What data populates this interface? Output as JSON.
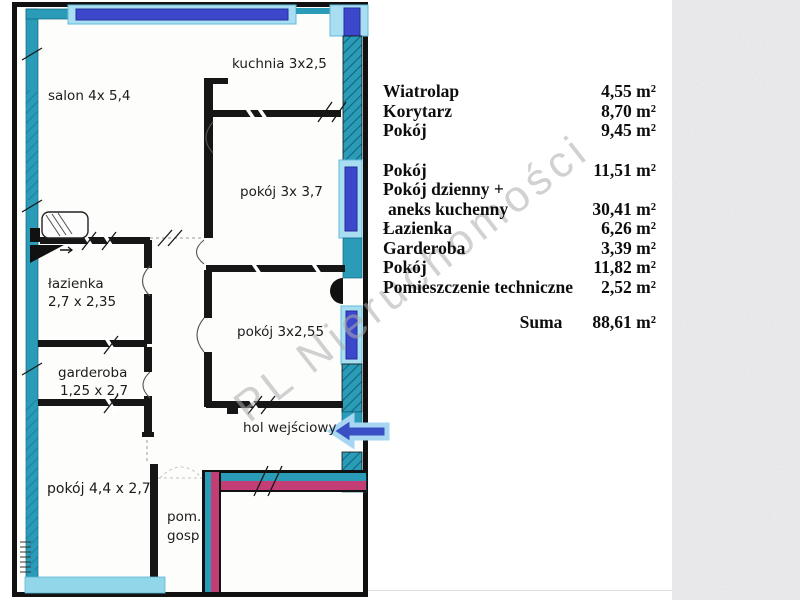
{
  "watermark": {
    "text": "PL Nieruchomości"
  },
  "plan": {
    "labels": {
      "salon": "salon 4x 5,4",
      "kuchnia": "kuchnia 3x2,5",
      "pokoj37": "pokój 3x 3,7",
      "lazienka1": "łazienka",
      "lazienka2": "2,7 x 2,35",
      "garderoba1": "garderoba",
      "garderoba2": "1,25 x 2,7",
      "pokoj255": "pokój 3x2,55",
      "hol": "hol wejściowy",
      "pokoj44": "pokój 4,4 x 2,7",
      "pom1": "pom.",
      "pom2": "gosp"
    },
    "colors": {
      "wall_teal": "#2a9cb8",
      "wall_teal_dark": "#10657f",
      "window_frame": "#a9ddf0",
      "window_blue": "#3c47cb",
      "wall_magenta": "#c23e74",
      "bottom_bar": "#92d6ea",
      "arrow_fill": "#3a4fc4",
      "arrow_border": "#a6d6f2"
    }
  },
  "areas": {
    "rows": [
      {
        "name": "Wiatrolap",
        "value": "4,55 m²"
      },
      {
        "name": "Korytarz",
        "value": "8,70 m²"
      },
      {
        "name": "Pokój",
        "value": "9,45 m²"
      },
      {
        "name": "Pokój",
        "value": "11,51 m²"
      },
      {
        "name": "Pokój dzienny +",
        "value": ""
      },
      {
        "name": "aneks kuchenny",
        "value": "30,41 m²"
      },
      {
        "name": "Łazienka",
        "value": "6,26 m²"
      },
      {
        "name": "Garderoba",
        "value": "3,39 m²"
      },
      {
        "name": "Pokój",
        "value": "11,82 m²"
      },
      {
        "name": "Pomieszczenie techniczne",
        "value": "2,52 m²"
      }
    ],
    "total_label": "Suma",
    "total_value": "88,61 m²"
  }
}
